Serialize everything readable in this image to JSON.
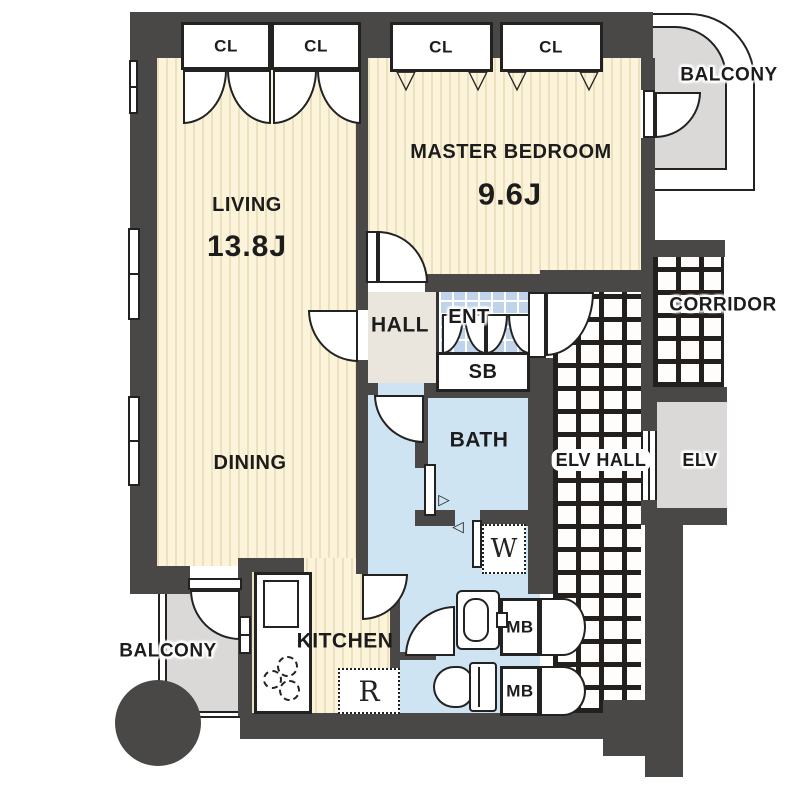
{
  "plan_title": "2LDK apartment floor plan",
  "rooms": {
    "living": {
      "name": "LIVING",
      "size": "13.8J"
    },
    "dining": {
      "name": "DINING"
    },
    "master_bedroom": {
      "name": "MASTER BEDROOM",
      "size": "9.6J"
    },
    "kitchen": {
      "name": "KITCHEN"
    },
    "hall": {
      "name": "HALL"
    },
    "entrance": {
      "name": "ENT"
    },
    "shoe_box": {
      "name": "SB"
    },
    "bath": {
      "name": "BATH"
    },
    "corridor": {
      "name": "CORRIDOR"
    },
    "elevator_hall": {
      "name": "ELV HALL"
    },
    "elevator": {
      "name": "ELV"
    },
    "balcony_top": {
      "name": "BALCONY"
    },
    "balcony_bottom": {
      "name": "BALCONY"
    }
  },
  "closets": {
    "labels": [
      "CL",
      "CL",
      "CL",
      "CL"
    ]
  },
  "meter_boxes": {
    "labels": [
      "MB",
      "MB"
    ]
  },
  "appliances": {
    "washer": "W",
    "refrigerator": "R"
  },
  "icons": {
    "folding_door": "▽",
    "slide_left": "◁",
    "slide_right": "▷"
  },
  "colors": {
    "wall": "#4a4846",
    "wood_floor": "#fbf3da",
    "wet_area": "#cfe4f2",
    "entrance_tile": "#bfd3ea",
    "balcony": "#dbd9d7",
    "hall": "#eae6de"
  }
}
